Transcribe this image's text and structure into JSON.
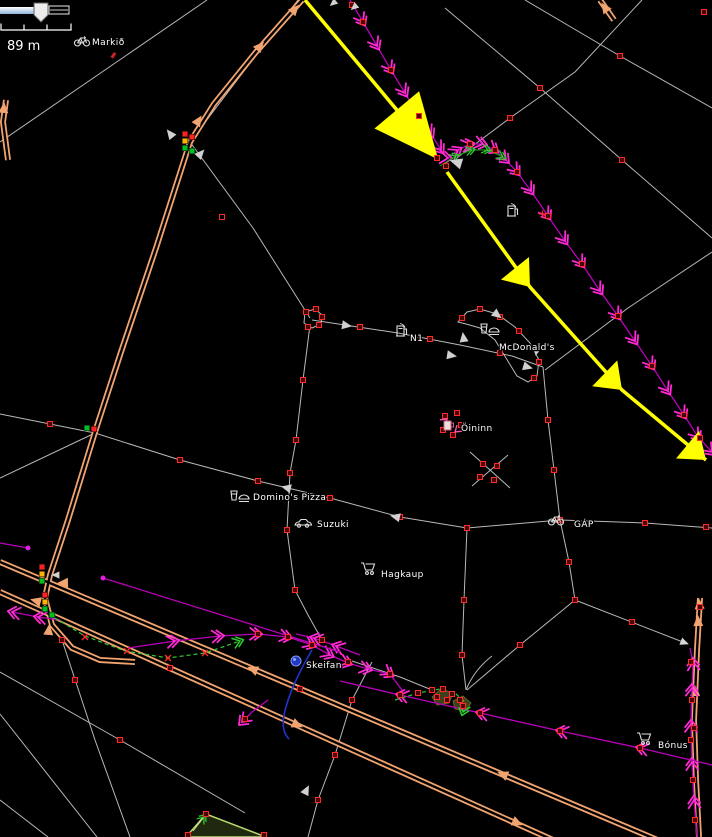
{
  "map_overlay": {
    "scale_label": "89 m"
  },
  "pois": [
    {
      "label": "Markið",
      "icon": "bicycle-icon"
    },
    {
      "label": "N1",
      "icon": "fuel-pump-icon"
    },
    {
      "label": "",
      "icon": "fuel-pump-icon"
    },
    {
      "label": "McDonald's",
      "icon": "fast-food-icon"
    },
    {
      "label": "Öininn",
      "icon": "bar-icon"
    },
    {
      "label": "Domino's Pizza",
      "icon": "fast-food-icon"
    },
    {
      "label": "Suzuki",
      "icon": "car-icon"
    },
    {
      "label": "Hagkaup",
      "icon": "shopping-cart-icon"
    },
    {
      "label": "GÁP",
      "icon": "bicycle-icon"
    },
    {
      "label": "Skeifan",
      "icon": "place-icon"
    },
    {
      "label": "Bónus",
      "icon": "shopping-cart-icon"
    }
  ],
  "colors": {
    "background": "#000000",
    "route_highlight": "#ffff00",
    "gps_track": "#bb00bb",
    "track_arrow": "#ff2ad4",
    "major_road": "#f2a470",
    "minor_road": "#b8b8b8",
    "node": "#ff2a2a",
    "signal_red": "#ff2020",
    "signal_yellow": "#ffb000",
    "signal_green": "#00c020",
    "survey_track": "#2ecc2e",
    "water_blue": "#2233cc",
    "area_green_border": "#b9d870"
  }
}
